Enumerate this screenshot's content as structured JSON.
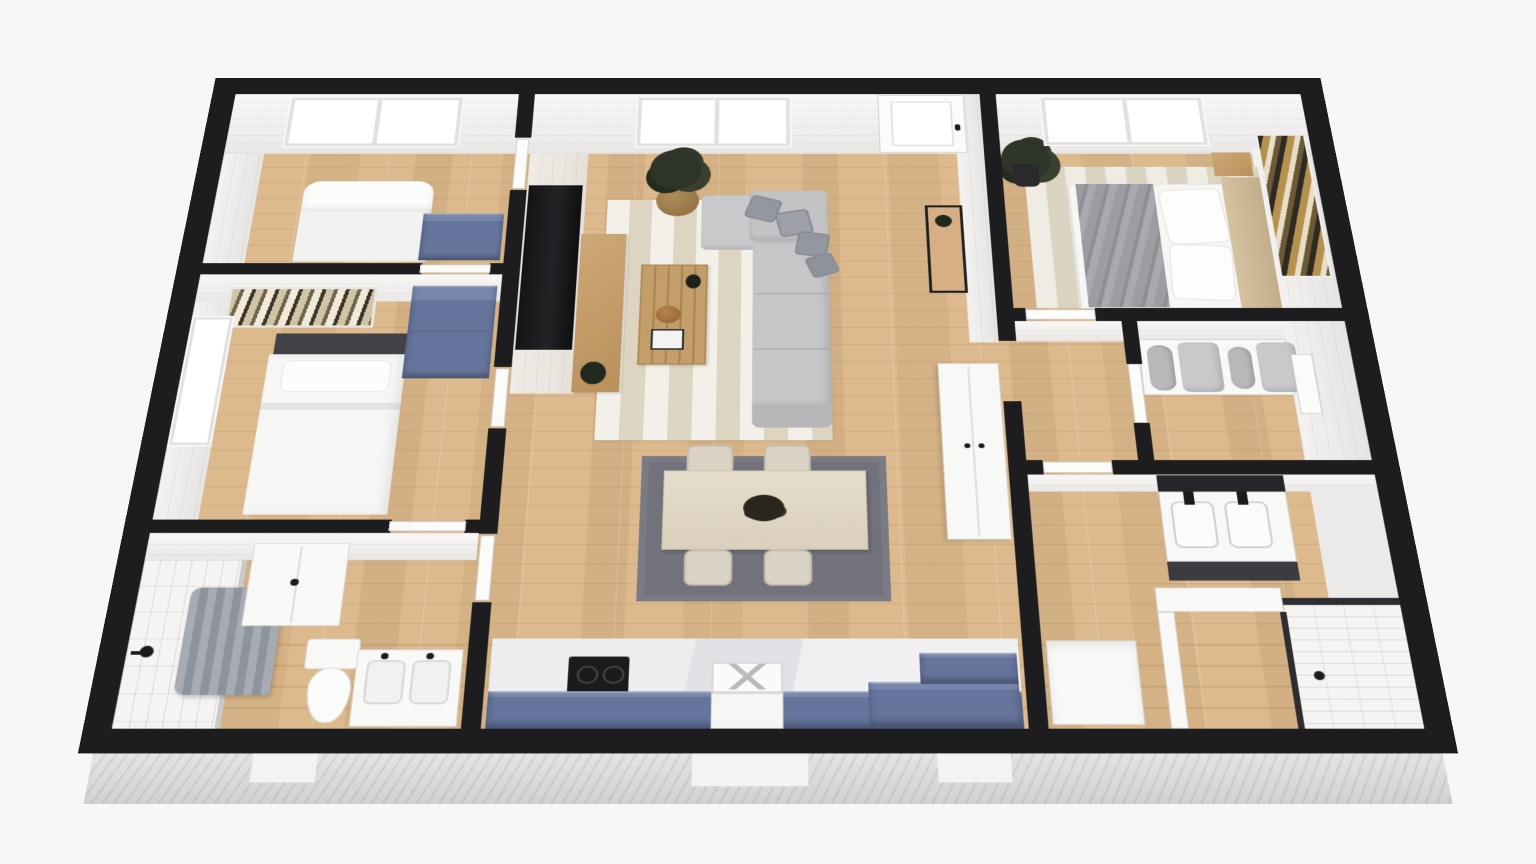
{
  "scene": {
    "title": "3D dollhouse-style apartment floor plan rendering, viewed from above",
    "background_color": "#f7f7f7",
    "text_on_screen": "none"
  },
  "palette": {
    "cut_wall_black": "#1d1d1f",
    "wall_face_white": "#f2f1ef",
    "wood_floor": "#dcba8e",
    "cabinet_blue": "#66759c",
    "sofa_gray": "#c5c5c8",
    "pillow_gray": "#94979f",
    "living_rug_stripe": "#ddd5c2",
    "dining_rug_gray": "#72727c",
    "subway_tile": "#f5f4f2",
    "marble_counter": "#ebebee",
    "wood_furniture": "#c49e6a",
    "exterior_siding": "#d8d8db",
    "glass_panel_dark": "#2e2e32"
  },
  "rooms": {
    "bedroom1": {
      "name": "Bedroom 1 (top left)",
      "furniture": [
        "white bed with rolled duvet",
        "blue dresser",
        "wide two-pane window",
        "door to living room"
      ]
    },
    "bedroom2": {
      "name": "Bedroom 2 (middle left)",
      "furniture": [
        "bed with dark headboard and white duvet",
        "botanical wall art above bed",
        "blue dresser",
        "side window on west wall",
        "door to living room"
      ]
    },
    "bathroom1": {
      "name": "Bathroom (bottom left)",
      "furniture": [
        "subway-tiled shower with gray curtain and black shower head",
        "white wall cabinet",
        "toilet",
        "double-sink vanity with black faucets",
        "door to living room"
      ]
    },
    "living": {
      "name": "Living room (center)",
      "furniture": [
        "L-shaped gray sectional sofa with 4 gray pillows",
        "striped beige area rug",
        "slatted wood coffee table with vase, gourd and books",
        "wall-mounted TV",
        "wood media console",
        "round plant stand with potted plant",
        "white double-door pantry cabinet",
        "black-frame entry console table with plant",
        "front door with glass panel",
        "two-pane window"
      ]
    },
    "dining": {
      "name": "Dining area (center)",
      "furniture": [
        "light wood dining table",
        "4 upholstered chairs (2 north, 2 south)",
        "dark gray rug",
        "dark floral centerpiece"
      ]
    },
    "kitchen": {
      "name": "Kitchen (bottom center)",
      "furniture": [
        "marble countertop run",
        "black cooktop with two burners",
        "white farmhouse sink with drying grid",
        "blue base cabinet fronts",
        "raised L-shaped blue corner cabinet"
      ]
    },
    "master": {
      "name": "Master bedroom (top right)",
      "furniture": [
        "queen bed with gray marble-pattern runner",
        "two white pillows",
        "beige headboard",
        "wood nightstand",
        "striped beige rug",
        "dark potted plant",
        "gold and black abstract wall art on east wall",
        "two-pane window",
        "door to hallway"
      ]
    },
    "closet": {
      "name": "Walk-in closet (right)",
      "furniture": [
        "white bench shelf",
        "two gray bolster cushions",
        "two gray pad cushions",
        "white door panel",
        "door to hallway"
      ]
    },
    "bathroom2": {
      "name": "Bathroom 2 (right)",
      "furniture": [
        "black-framed mirror",
        "white double-sink vanity with black faucets",
        "dark vanity front",
        "walk-in shower with subway tile, glass panel and floor drain",
        "white half wall"
      ]
    },
    "laundry": {
      "name": "Laundry nook (bottom right of kitchen wall)",
      "furniture": [
        "white appliance"
      ]
    },
    "hallway": {
      "name": "Hallway (right of living room)",
      "furniture": [
        "white interior door leaves"
      ]
    }
  },
  "exterior": {
    "features": [
      "thick black cut walls outlining every room",
      "light gray clapboard siding visible below the south wall",
      "three white step/vent blocks along the siding",
      "white wall faces with shiplap lines at the north side of each room"
    ]
  },
  "window_count": 5,
  "door_count": 9
}
